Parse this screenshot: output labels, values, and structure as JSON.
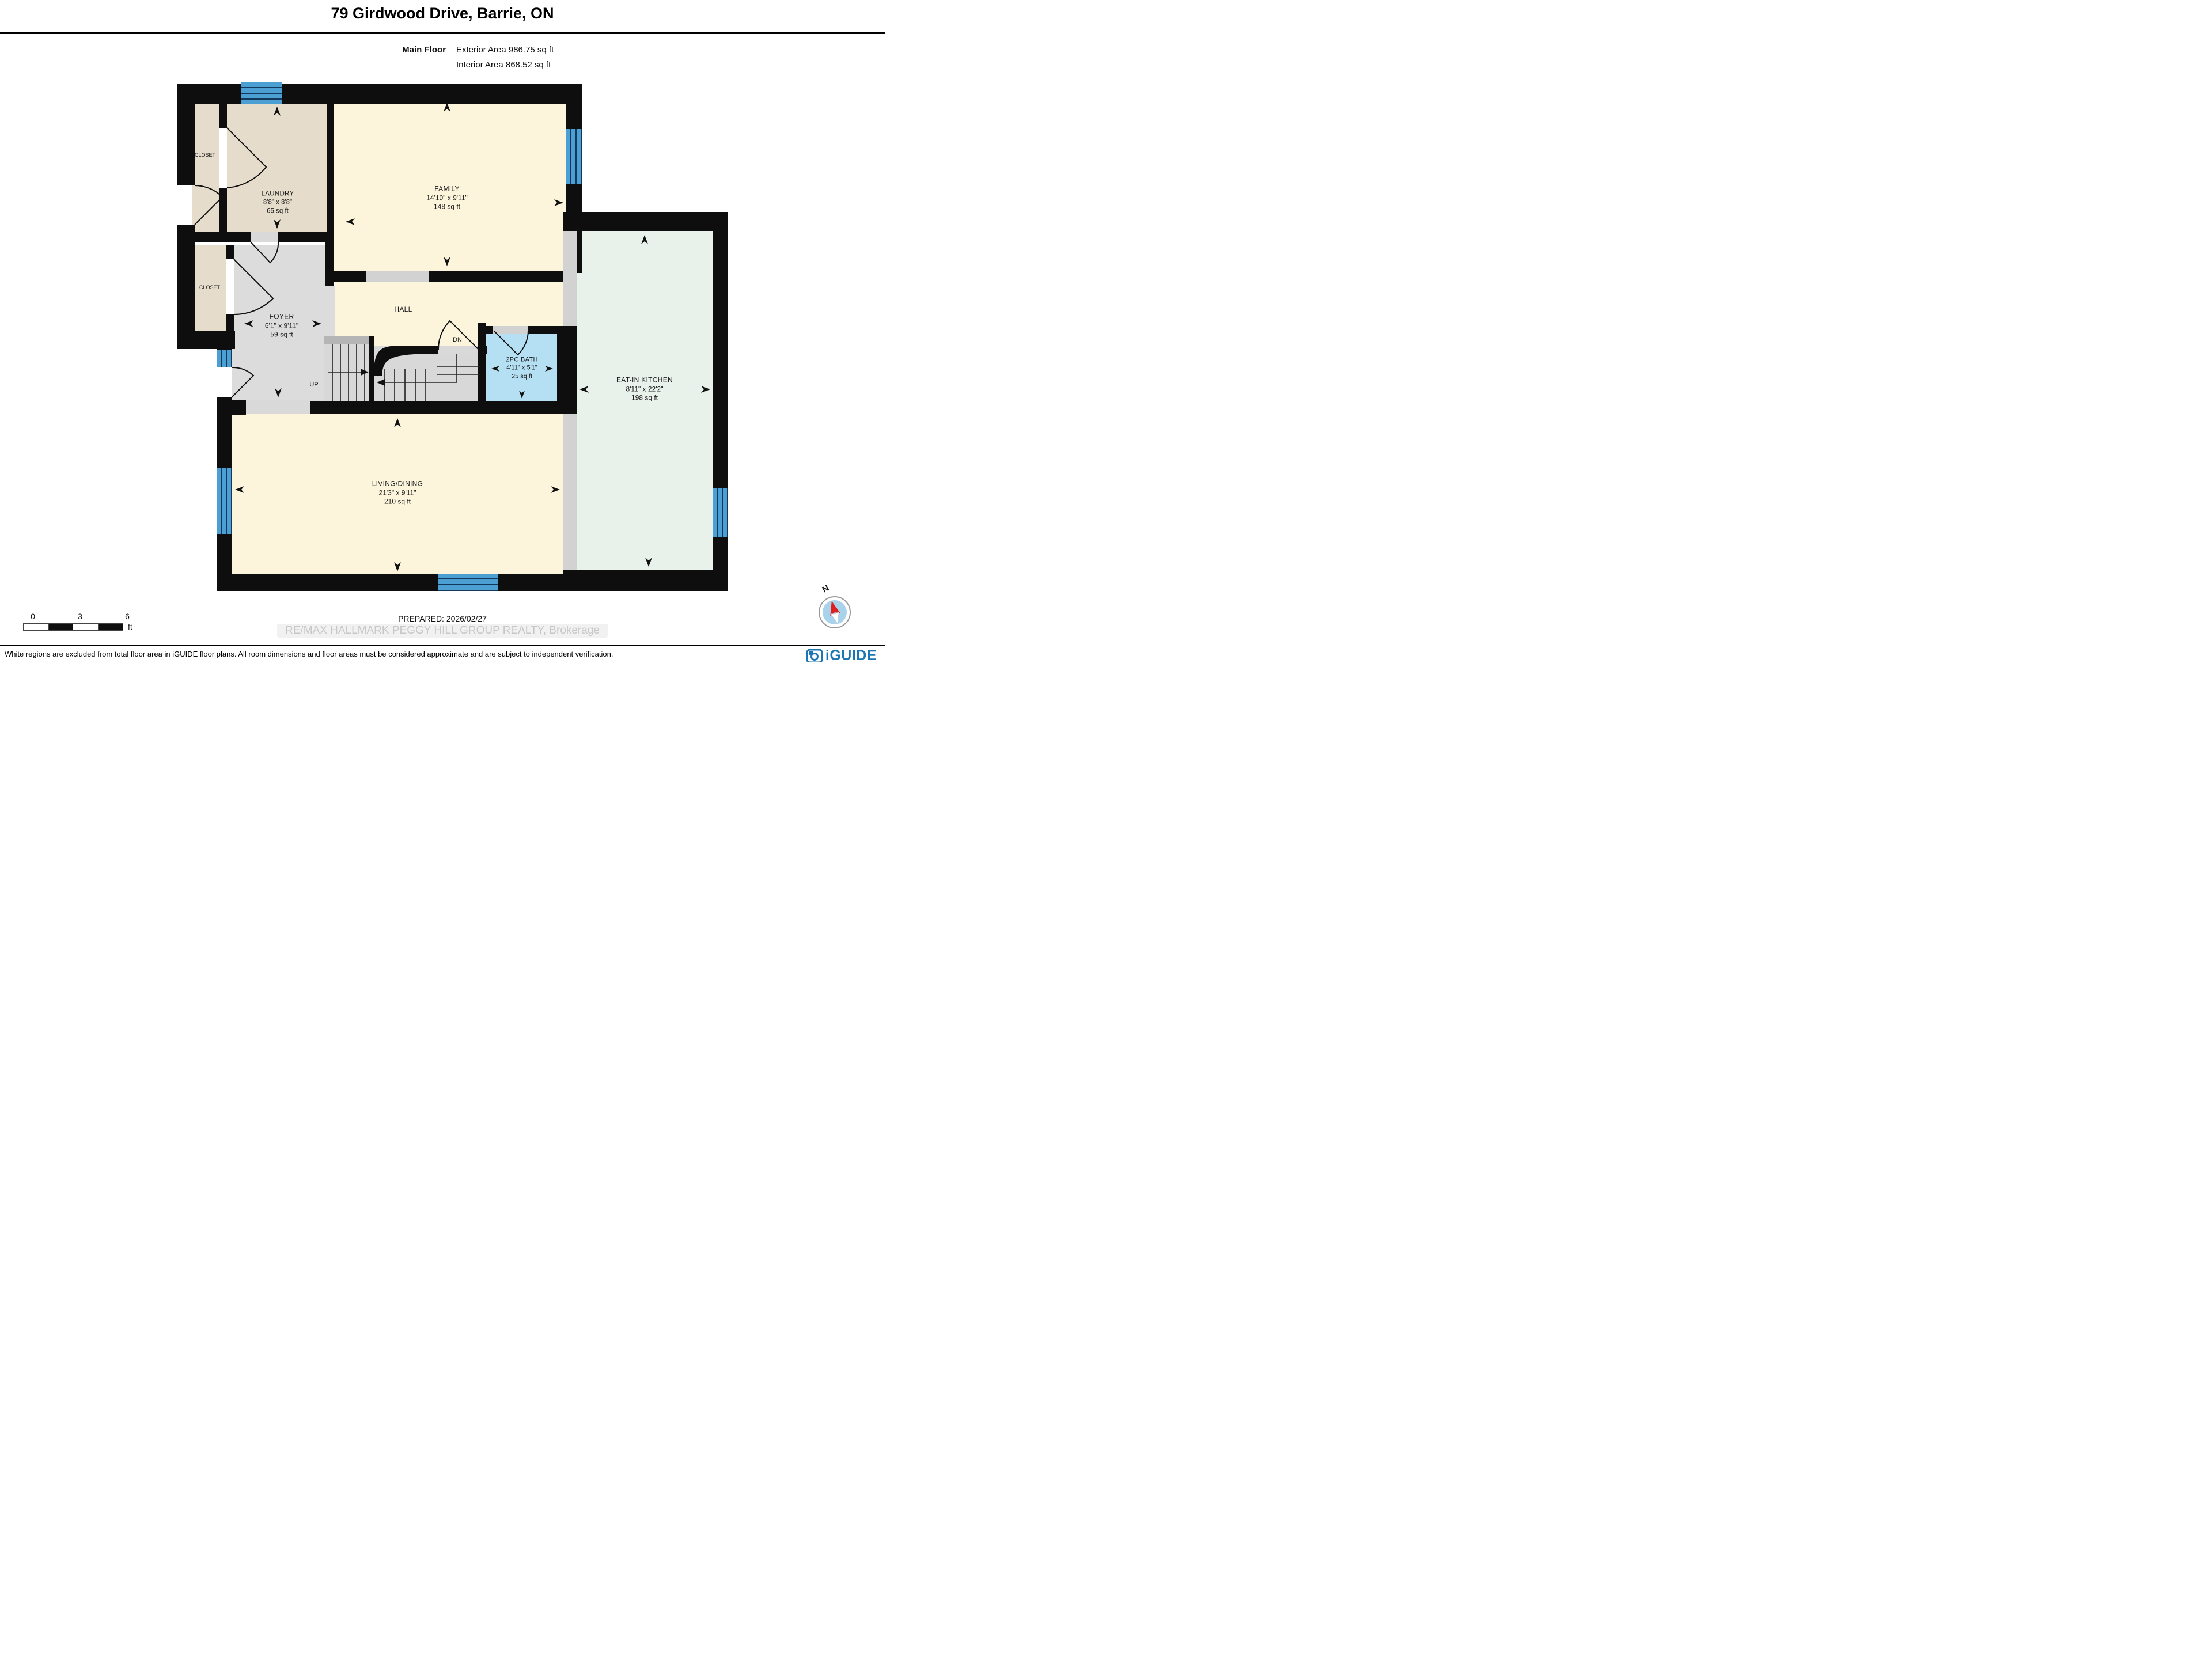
{
  "header": {
    "title": "79 Girdwood Drive, Barrie, ON",
    "floor_label": "Main Floor",
    "exterior_area": "Exterior Area 986.75 sq ft",
    "interior_area": "Interior Area 868.52 sq ft"
  },
  "rooms": {
    "laundry": {
      "name": "LAUNDRY",
      "dims": "8'8\" x 8'8\"",
      "area": "65 sq ft"
    },
    "family": {
      "name": "FAMILY",
      "dims": "14'10\" x 9'11\"",
      "area": "148 sq ft"
    },
    "foyer": {
      "name": "FOYER",
      "dims": "6'1\" x 9'11\"",
      "area": "59 sq ft"
    },
    "hall": {
      "name": "HALL"
    },
    "bath": {
      "name": "2PC BATH",
      "dims": "4'11\" x 5'1\"",
      "area": "25 sq ft"
    },
    "kitchen": {
      "name": "EAT-IN KITCHEN",
      "dims": "8'11\" x 22'2\"",
      "area": "198 sq ft"
    },
    "living": {
      "name": "LIVING/DINING",
      "dims": "21'3\" x 9'11\"",
      "area": "210 sq ft"
    },
    "closet_top": {
      "name": "CLOSET"
    },
    "closet_mid": {
      "name": "CLOSET"
    },
    "stairs_up": "UP",
    "stairs_down": "DN"
  },
  "scale_bar": {
    "tick0": "0",
    "tick3": "3",
    "tick6": "6",
    "unit": "ft"
  },
  "footer": {
    "prepared": "PREPARED: 2026/02/27",
    "watermark": "RE/MAX HALLMARK PEGGY HILL GROUP REALTY, Brokerage",
    "disclaimer": "White regions are excluded from total floor area in iGUIDE floor plans. All room dimensions and floor areas must be considered approximate and are subject to independent verification.",
    "brand": "iGUIDE"
  },
  "compass": {
    "north_label": "N"
  },
  "colors": {
    "wall": "#0e0e0e",
    "room_cream": "#fcf5dc",
    "room_tan": "#e6dccb",
    "room_gray": "#dcdcdc",
    "room_mint": "#e8f1ea",
    "bath_blue": "#b5e0f4",
    "window_blue": "#4b9fd2",
    "opening_gray": "#d2d2d2",
    "brand_blue": "#1c76b4",
    "compass_red": "#e02020"
  }
}
